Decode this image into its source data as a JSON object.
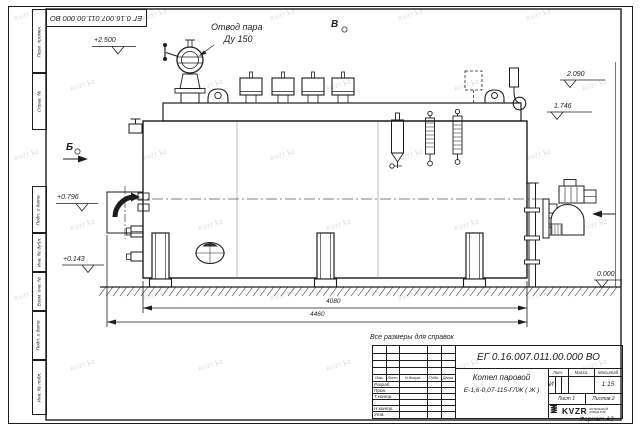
{
  "frame": {
    "corner_stamp": "ЕГ 0.16.007.011.00.000  ВО",
    "left_labels": [
      "Перв. примен.",
      "Справ. №",
      "Подп. и дата",
      "Инв. № дубл.",
      "Взам. инв. №",
      "Подп. и дата",
      "Инв. № подл."
    ],
    "format_note": "Формат А3"
  },
  "drawing": {
    "callout_line1": "Отвод пара",
    "callout_line2": "Ду 150",
    "view_label_left": "Б",
    "view_label_top": "В",
    "elev_steam": "+2.500",
    "elev_right_upper": "2.090",
    "elev_right_lower": "1.746",
    "elev_left_upper": "+0.796",
    "elev_left_lower": "+0.143",
    "elev_ground": "0.000",
    "dim_inner": "4080",
    "dim_outer": "4460",
    "note": "Все размеры для справок"
  },
  "title_block": {
    "designation": "ЕГ 0.16.007.011.00.000  ВО",
    "product_name_line1": "Котел паровой",
    "product_name_line2": "Е-1,6-0,07-115-ГЛЖ ( Ж )",
    "col_headers": [
      "Изм.",
      "Лист",
      "N докум.",
      "Подп.",
      "Дата"
    ],
    "row_labels": [
      "Разраб.",
      "Пров.",
      "Т.контр.",
      "",
      "Н.контр.",
      "Утв."
    ],
    "lit_header": "Лит.",
    "mass_header": "Масса",
    "scale_header": "Масштаб",
    "lit_value": "И",
    "scale_value": "1:15",
    "sheet_info": "Лист 1",
    "sheets_info": "Листов 2",
    "brand": "KVZR",
    "brand_sub1": "КОТЕЛЬНЫЙ",
    "brand_sub2": "ЗАВОД РЗР"
  },
  "watermark": {
    "text": "kvzr.kz"
  },
  "colors": {
    "line": "#1d1d1d",
    "watermark": "#c2cad1",
    "sheet": "#ffffff"
  }
}
